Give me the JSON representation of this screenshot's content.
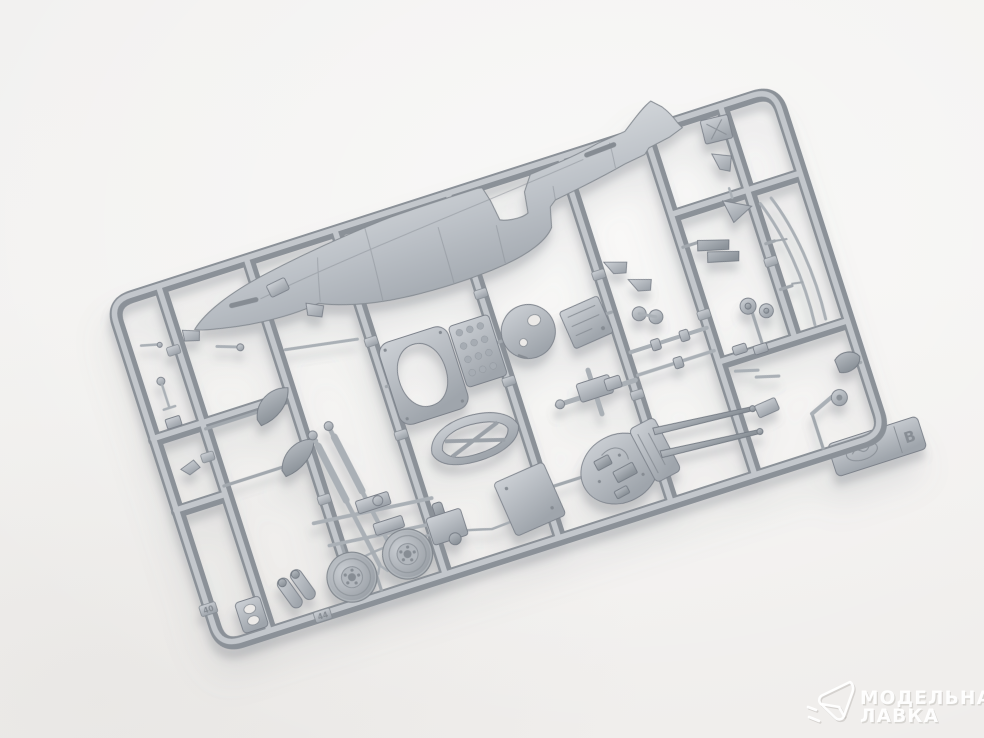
{
  "scene": {
    "description": "Photograph of a light-gray injection-molded plastic model-kit sprue (runner) with aircraft parts lying diagonally on a bright white studio background",
    "background_color": "#f2f1ef",
    "plastic_color": "#aab0b6",
    "shadow_color": "#7a7e85"
  },
  "sprue": {
    "runner_letter": "B",
    "tab_logo": "oval-brand-logo",
    "visible_part_numbers": [
      "40",
      "44"
    ],
    "parts_depicted": [
      "fuselage half",
      "main wheels (2)",
      "cockpit door frame with oval opening",
      "padded door panel",
      "teardrop fuselage frame",
      "bulkhead disc",
      "cockpit sidewall panel",
      "cannon breech",
      "machine guns (2)",
      "landing gear struts (2)",
      "fin blades (2)",
      "exhaust stubs",
      "tapered gun barrels (2)",
      "canopy rails",
      "tailwheel",
      "headrest",
      "twin cylinders",
      "brackets and levers",
      "control stick",
      "access plate",
      "equipment box",
      "wire bow"
    ]
  },
  "watermark": {
    "line1": "МОДЕЛЬНАЯ",
    "line2": "ЛАВКА",
    "logo": "paper-plane-logo",
    "color": "#ffffff"
  }
}
